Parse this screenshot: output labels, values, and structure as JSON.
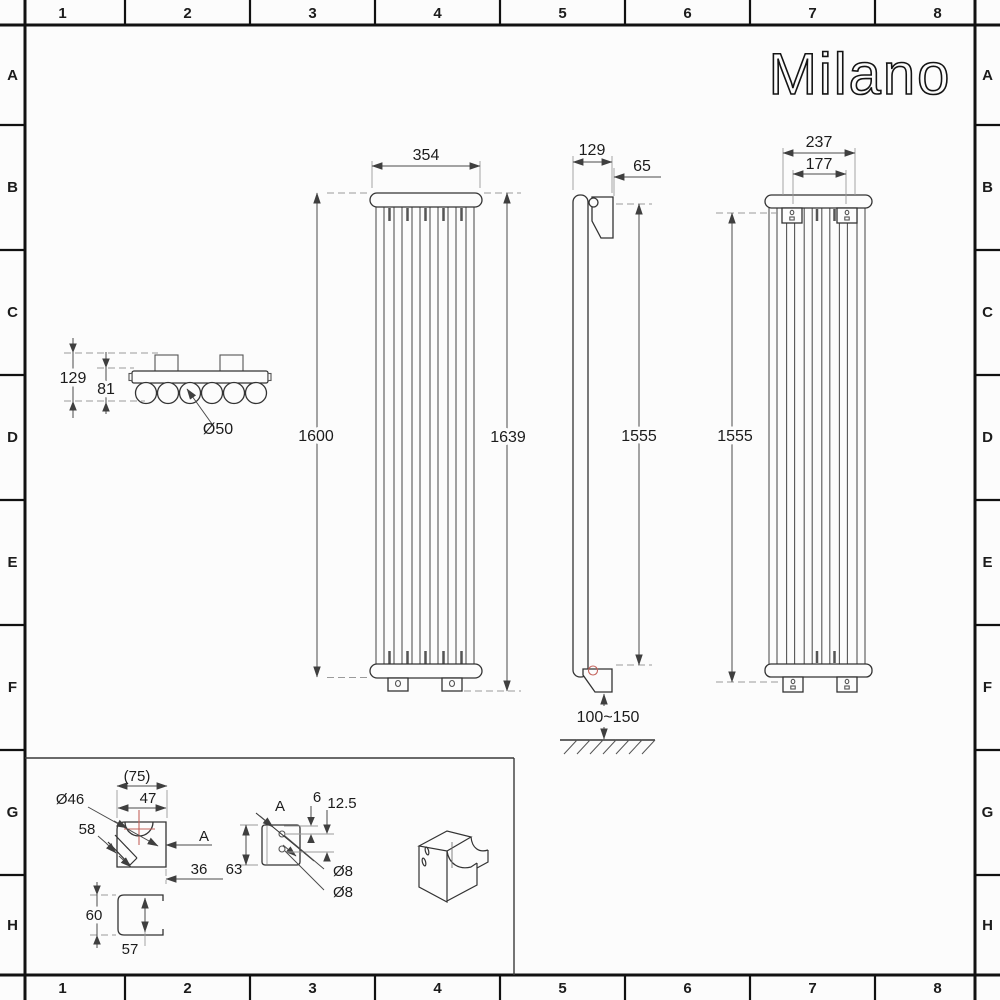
{
  "sheet": {
    "columns": [
      "1",
      "2",
      "3",
      "4",
      "5",
      "6",
      "7",
      "8"
    ],
    "rows": [
      "A",
      "B",
      "C",
      "D",
      "E",
      "F",
      "G",
      "H"
    ],
    "logo_text": "Milano"
  },
  "colors": {
    "accent_red": "#c4635c",
    "line": "#333333"
  },
  "views": {
    "cross_section": {
      "overall_depth": "129",
      "tube_offset": "81",
      "tube_diameter": "Ø50"
    },
    "front": {
      "width": "354",
      "height": "1600",
      "overall_height": "1639"
    },
    "side": {
      "depth": "129",
      "bracket_offset": "65",
      "bracket_span": "1555",
      "floor_clearance": "100~150"
    },
    "back": {
      "bracket_outer_width": "237",
      "bracket_center_width": "177",
      "bracket_span": "1555"
    },
    "bracket_detail": {
      "overall_width": "(75)",
      "width": "47",
      "saddle_diameter": "Ø46",
      "slot_length": "58",
      "section_label": "A",
      "depth": "36"
    },
    "u_channel_detail": {
      "outer_height": "60",
      "inner_height": "57"
    },
    "section_a_detail": {
      "label": "A",
      "hole_inset": "6",
      "hole_spacing": "12.5",
      "height": "63",
      "hole_diameter_top": "Ø8",
      "hole_diameter_bottom": "Ø8"
    }
  }
}
